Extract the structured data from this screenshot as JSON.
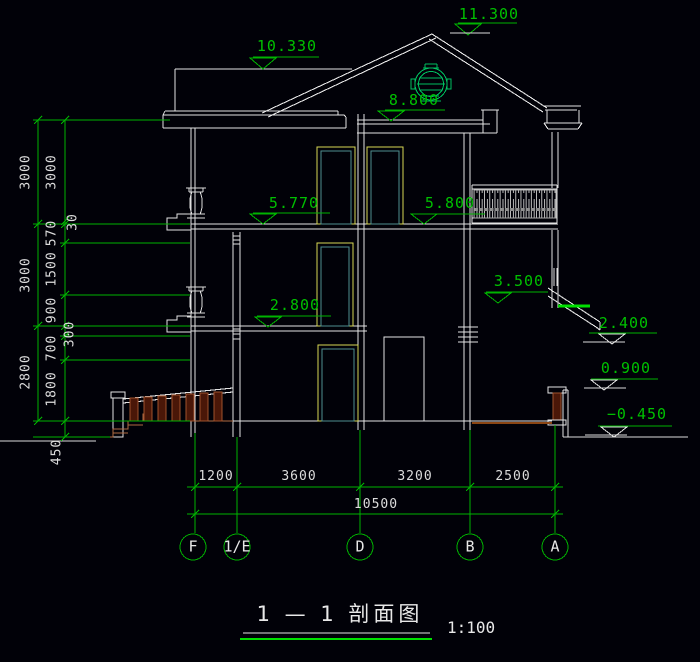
{
  "drawing": {
    "type": "building-section",
    "background": "#010108",
    "colors": {
      "dim_green": "#00c000",
      "highlight_green": "#00e800",
      "line_white": "#dcdcdc",
      "door_yellow": "#d8d855",
      "door_teal": "#4e8f8f",
      "wood_brown": "#a0522d",
      "wood_dark": "#4a1708"
    },
    "elevation_markers": {
      "ridge": "11.300",
      "parapet": "10.330",
      "attic_floor": "8.800",
      "third_floor_left": "5.770",
      "third_floor_right": "5.800",
      "canopy_top": "3.500",
      "second_floor": "2.800",
      "canopy_soffit": "2.400",
      "porch_wall": "0.900",
      "grade": "−0.450"
    },
    "dims_left": {
      "outer": [
        "3000",
        "3000",
        "2800"
      ],
      "inner": [
        "3000",
        "570",
        "1500",
        "900",
        "700",
        "1800"
      ],
      "inner_small": [
        "30",
        "300"
      ],
      "base": "450"
    },
    "dims_bottom": {
      "segments": [
        "1200",
        "3600",
        "3200",
        "2500"
      ],
      "total": "10500"
    },
    "grid": {
      "labels": [
        "F",
        "1/E",
        "D",
        "B",
        "A"
      ]
    },
    "titleblock": {
      "title": "1 — 1  剖面图",
      "scale": "1:100"
    }
  }
}
